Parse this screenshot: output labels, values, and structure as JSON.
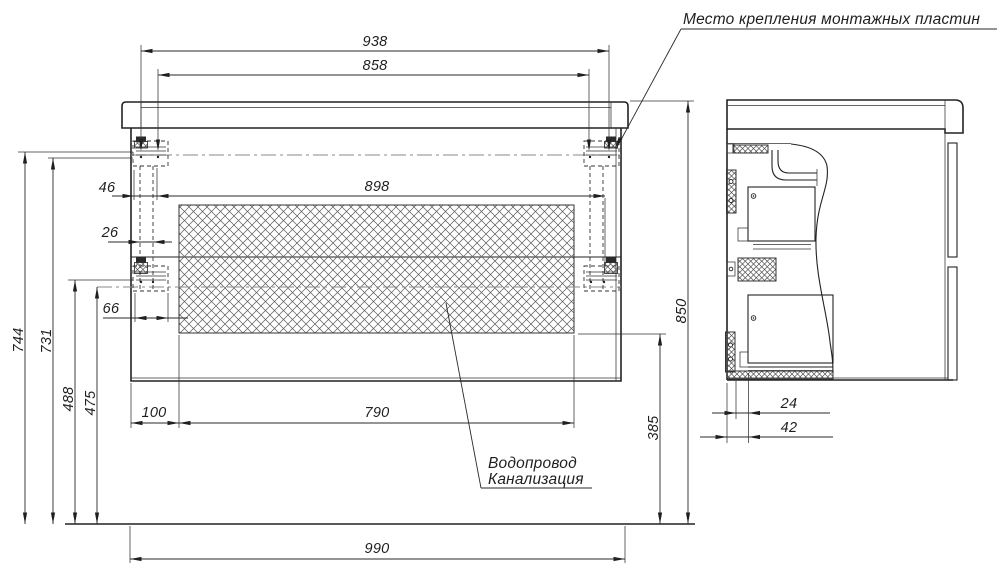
{
  "colors": {
    "ink": "#1f1f1f",
    "background": "#ffffff",
    "centerline": "#8a8a8a",
    "hatch": "#5a5a5a"
  },
  "annotations": {
    "mounting_plates": "Место крепления монтажных пластин",
    "plumbing_line1": "Водопровод",
    "plumbing_line2": "Канализация"
  },
  "dimensions_mm": {
    "front": {
      "mounting_span_outer": "938",
      "mounting_span_inner": "858",
      "back_opening_width": "898",
      "plate_offset_a": "46",
      "plate_offset_b": "26",
      "plate_offset_c": "66",
      "floor_to_upper_plate_top": "744",
      "floor_to_upper_plate_slot": "731",
      "floor_to_lower_plate_top": "488",
      "floor_to_lower_plate_axis": "475",
      "opening_side_offset": "100",
      "opening_bottom_width": "790",
      "floor_to_opening_bottom": "385",
      "overall_height": "850",
      "overall_width": "990"
    },
    "side": {
      "back_gap_inner": "24",
      "back_gap_outer": "42"
    }
  }
}
